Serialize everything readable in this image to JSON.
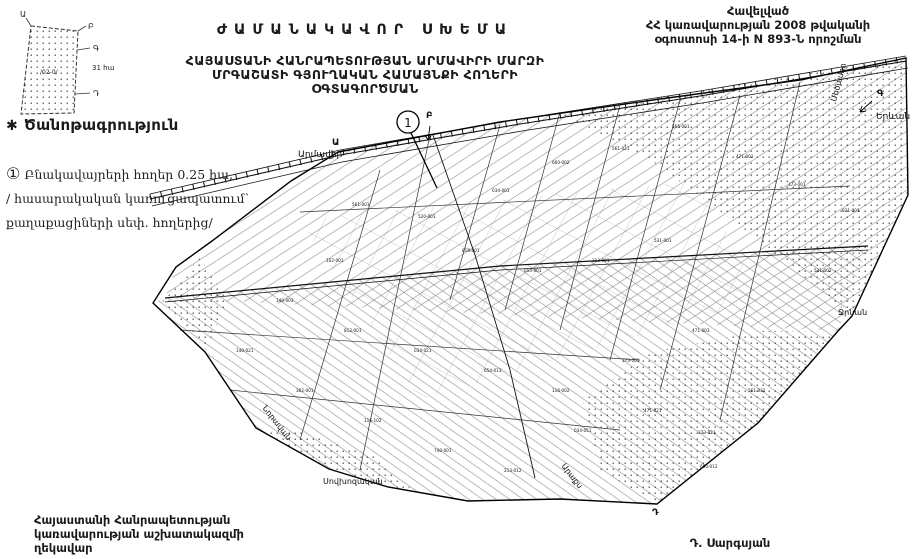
{
  "document": {
    "title": "ԺԱՄԱՆԱԿԱՎՈՐ ՍԽԵՄԱ",
    "subtitle_line1": "ՀԱՅԱՍՏԱՆԻ ՀԱՆՐԱՊԵՏՈՒԹՅԱՆ ԱՐՄԱՎԻՐԻ ՄԱՐԶԻ",
    "subtitle_line2": "ՄՐԳԱՇԱՏԻ ԳՅՈՒՂԱԿԱՆ ՀԱՄԱՅՆՔԻ ՀՈՂԵՐԻ",
    "subtitle_line3": "ՕԳՏԱԳՈՐԾՄԱՆ"
  },
  "annex": {
    "line1": "Հավելված",
    "line2": "ՀՀ կառավարության 2008 թվականի",
    "line3": "օգոստոսի 14-ի N 893-Ն որոշման"
  },
  "legend": {
    "star": "✱",
    "heading": "Ծանոթագրություն",
    "item_marker": "①",
    "item_line1": "Բնակավայրերի հողեր  0.25 հա,",
    "item_line2": "/ հասարակական կառուցապատում՝",
    "item_line3": "քաղաքացիների սեփ. հողերից/"
  },
  "signature": {
    "left_line1": "Հայաստանի Հանրապետության",
    "left_line2": "կառավարության աշխատակազմի",
    "left_line3": "ղեկավար",
    "right_name": "Դ. Սարգսյան"
  },
  "inset": {
    "vertex_a": "Ա",
    "vertex_b": "Բ",
    "vertex_c": "Գ",
    "vertex_d": "Դ",
    "code": "/02-0/",
    "area": "31 հա"
  },
  "map": {
    "marker": "1",
    "colors": {
      "ink": "#1a1a1a",
      "paper": "#ffffff"
    },
    "labels": [
      {
        "name": "armavir",
        "text": "Արմավիր",
        "x": 298,
        "y": 157,
        "rot": 0,
        "size": 9
      },
      {
        "name": "metsamor",
        "text": "Մեծամոր",
        "x": 836,
        "y": 102,
        "rot": -75,
        "size": 8
      },
      {
        "name": "yerevan",
        "text": "Երևան",
        "x": 876,
        "y": 119,
        "rot": 0,
        "size": 9
      },
      {
        "name": "jrnan",
        "text": "Ջրնան",
        "x": 838,
        "y": 315,
        "rot": 0,
        "size": 8
      },
      {
        "name": "noravan",
        "text": "Նորավան",
        "x": 262,
        "y": 408,
        "rot": 52,
        "size": 8
      },
      {
        "name": "sovkhozakan",
        "text": "Սովխոզական",
        "x": 323,
        "y": 484,
        "rot": 0,
        "size": 8
      },
      {
        "name": "araks",
        "text": "Արաքս",
        "x": 561,
        "y": 466,
        "rot": 52,
        "size": 8
      },
      {
        "name": "vertex-a",
        "text": "Ա",
        "x": 332,
        "y": 145,
        "rot": 0,
        "size": 9,
        "bold": true
      },
      {
        "name": "vertex-b",
        "text": "Բ",
        "x": 426,
        "y": 118,
        "rot": 0,
        "size": 9,
        "bold": true
      },
      {
        "name": "vertex-c",
        "text": "Գ",
        "x": 877,
        "y": 96,
        "rot": 0,
        "size": 9,
        "bold": true
      },
      {
        "name": "vertex-d",
        "text": "Դ",
        "x": 652,
        "y": 515,
        "rot": 0,
        "size": 9,
        "bold": true
      }
    ],
    "parcel_codes": [
      {
        "t": "561-001",
        "x": 352,
        "y": 206
      },
      {
        "t": "520-001",
        "x": 418,
        "y": 218
      },
      {
        "t": "034-001",
        "x": 492,
        "y": 192
      },
      {
        "t": "660-002",
        "x": 552,
        "y": 164
      },
      {
        "t": "561-021",
        "x": 612,
        "y": 150
      },
      {
        "t": "565-001",
        "x": 672,
        "y": 128
      },
      {
        "t": "471-001",
        "x": 736,
        "y": 158
      },
      {
        "t": "373-001",
        "x": 788,
        "y": 186
      },
      {
        "t": "821-001",
        "x": 842,
        "y": 212
      },
      {
        "t": "818-001",
        "x": 462,
        "y": 252
      },
      {
        "t": "654-001",
        "x": 524,
        "y": 272
      },
      {
        "t": "213-001",
        "x": 592,
        "y": 262
      },
      {
        "t": "531-001",
        "x": 654,
        "y": 242
      },
      {
        "t": "102-001",
        "x": 326,
        "y": 262
      },
      {
        "t": "140-003",
        "x": 276,
        "y": 302
      },
      {
        "t": "812-001",
        "x": 344,
        "y": 332
      },
      {
        "t": "034-021",
        "x": 414,
        "y": 352
      },
      {
        "t": "654-013",
        "x": 484,
        "y": 372
      },
      {
        "t": "116-002",
        "x": 552,
        "y": 392
      },
      {
        "t": "373-005",
        "x": 622,
        "y": 362
      },
      {
        "t": "471-003",
        "x": 692,
        "y": 332
      },
      {
        "t": "302-001",
        "x": 296,
        "y": 392
      },
      {
        "t": "116-102",
        "x": 364,
        "y": 422
      },
      {
        "t": "740-001",
        "x": 434,
        "y": 452
      },
      {
        "t": "213-012",
        "x": 504,
        "y": 472
      },
      {
        "t": "034-051",
        "x": 574,
        "y": 432
      },
      {
        "t": "471-021",
        "x": 644,
        "y": 412
      },
      {
        "t": "373-021",
        "x": 698,
        "y": 434
      },
      {
        "t": "531-002",
        "x": 814,
        "y": 272
      },
      {
        "t": "140-021",
        "x": 236,
        "y": 352
      },
      {
        "t": "561-031",
        "x": 748,
        "y": 392
      },
      {
        "t": "660-012",
        "x": 700,
        "y": 468
      }
    ]
  }
}
